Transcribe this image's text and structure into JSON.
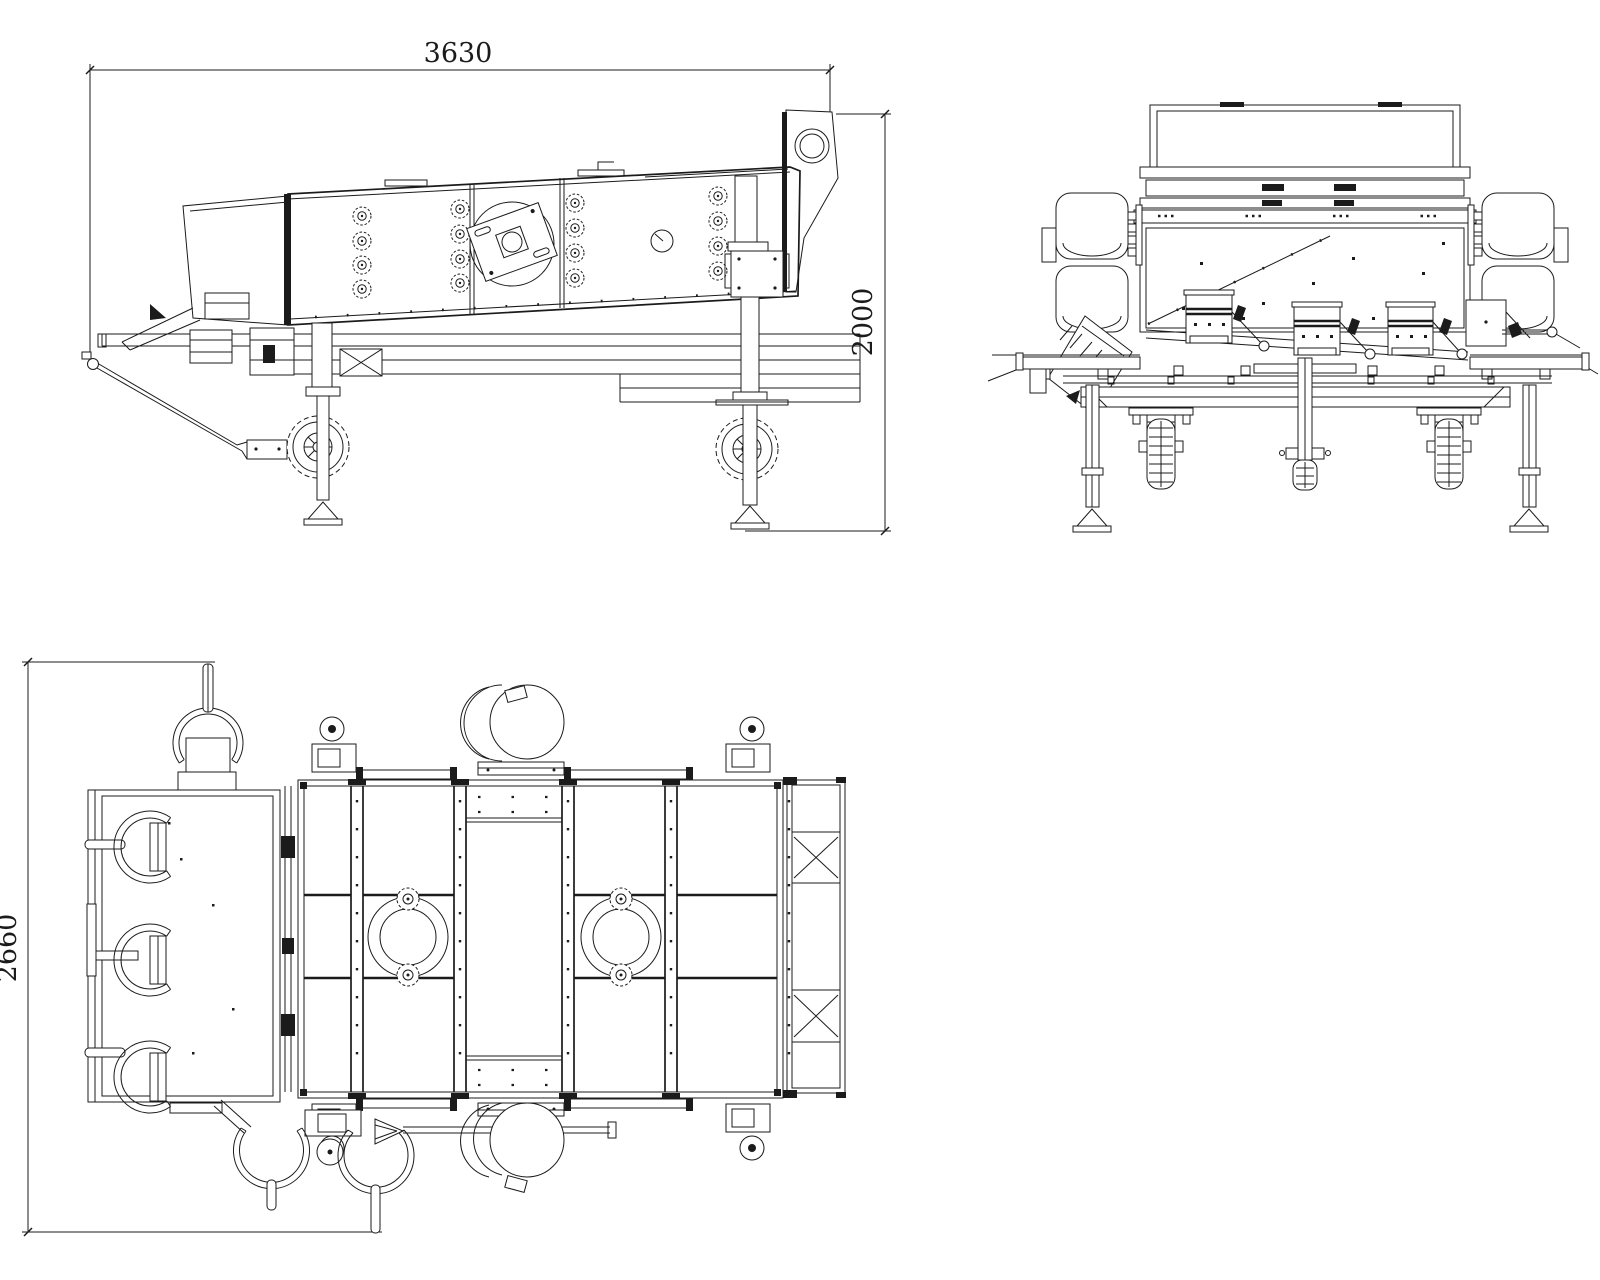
{
  "drawing": {
    "type": "cad-three-view-technical-drawing",
    "subject": "mobile vibrating screen machine",
    "style": {
      "line_color": "#1b1b1b",
      "background": "#ffffff"
    },
    "dimensions": {
      "overall_length_mm": "3630",
      "overall_height_mm": "2000",
      "overall_width_mm": "2660"
    }
  }
}
